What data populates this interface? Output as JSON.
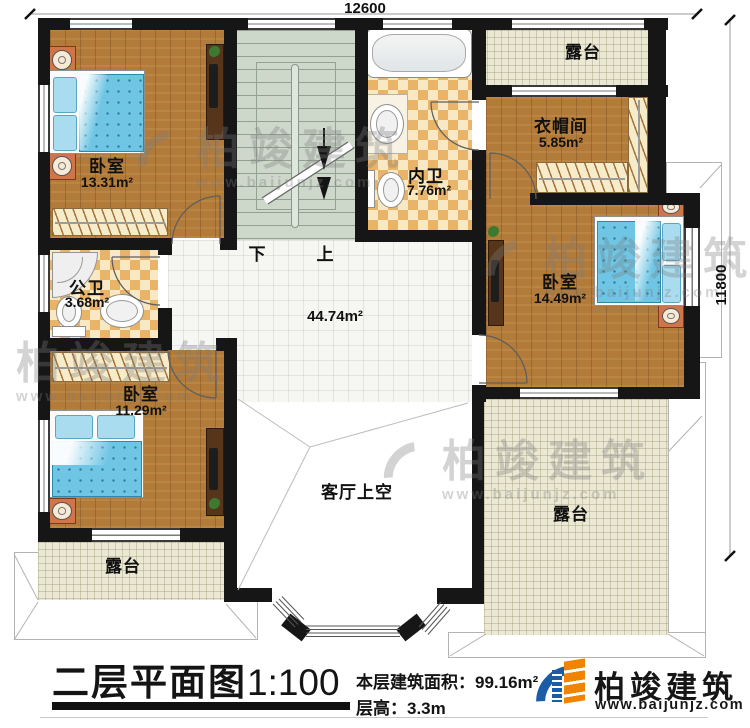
{
  "dimensions": {
    "top": "12600",
    "right": "11800"
  },
  "rooms": {
    "bedroom_tl": {
      "name": "卧室",
      "area": "13.31m²"
    },
    "bath_inner": {
      "name": "内卫",
      "area": "7.76m²"
    },
    "cloakroom": {
      "name": "衣帽间",
      "area": "5.85m²"
    },
    "bedroom_right": {
      "name": "卧室",
      "area": "14.49m²"
    },
    "bath_public": {
      "name": "公卫",
      "area": "3.68m²"
    },
    "bedroom_bl": {
      "name": "卧室",
      "area": "11.29m²"
    },
    "hall": {
      "area": "44.74m²"
    },
    "void": {
      "name": "客厅上空"
    },
    "terrace_top": {
      "name": "露台"
    },
    "terrace_bl": {
      "name": "露台"
    },
    "terrace_br": {
      "name": "露台"
    }
  },
  "stairs": {
    "down": "下",
    "up": "上"
  },
  "footer": {
    "title": "二层平面图",
    "scale": "1:100",
    "area_label": "本层建筑面积：",
    "area_value": "99.16m²",
    "height_label": "层高：",
    "height_value": "3.3m"
  },
  "brand": {
    "name": "柏竣建筑",
    "website": "www.baijunjz.com"
  },
  "watermark": {
    "name": "柏竣建筑",
    "website": "www.baijunjz.com"
  },
  "colors": {
    "wall": "#161616",
    "wood": "#b27b39",
    "bed_blue": "#6ec5e4",
    "stairs": "#cdd7ca",
    "tile_accent": "#e9b468",
    "terrace": "#ebe8d4",
    "brand_blue": "#1b5ca6",
    "brand_orange": "#f08300"
  }
}
